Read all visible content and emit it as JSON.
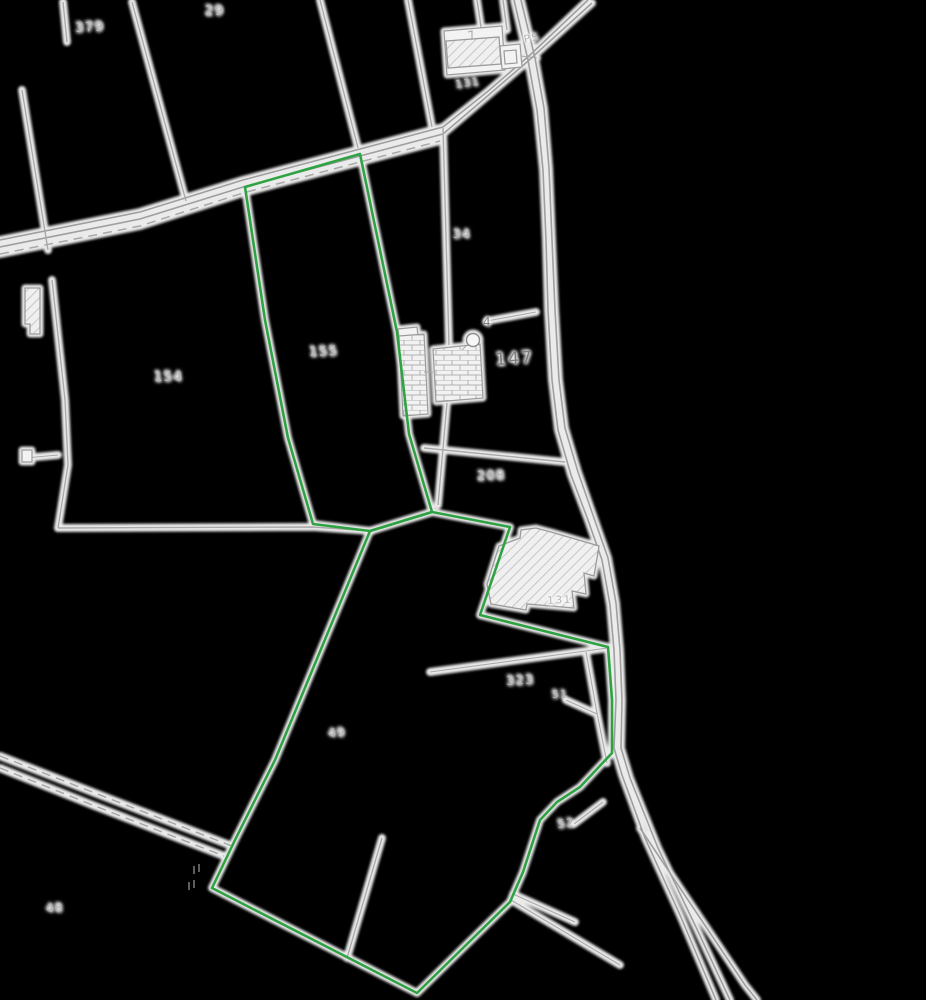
{
  "map": {
    "labels": [
      {
        "text": "379"
      },
      {
        "text": "29"
      },
      {
        "text": "PS"
      },
      {
        "text": "131"
      },
      {
        "text": "155"
      },
      {
        "text": "154"
      },
      {
        "text": "34"
      },
      {
        "text": "147"
      },
      {
        "text": "4"
      },
      {
        "text": "208"
      },
      {
        "text": "131"
      },
      {
        "text": "323"
      },
      {
        "text": "51"
      },
      {
        "text": "49"
      },
      {
        "text": "52"
      },
      {
        "text": "48"
      }
    ],
    "symbols": [
      {
        "name": "well-circle-symbol"
      }
    ],
    "colors": {
      "background": "#000000",
      "boundary_green": "#2fa344",
      "road_gray": "#9f9f9f",
      "parcel_gray": "#a9a9a9",
      "halo_white": "#ffffff",
      "label_gray": "#b4b4b4",
      "label_dark": "#7e7e7e",
      "building_fill": "#f1f1f1",
      "building_hatch_line": "#bcbcbc"
    }
  }
}
